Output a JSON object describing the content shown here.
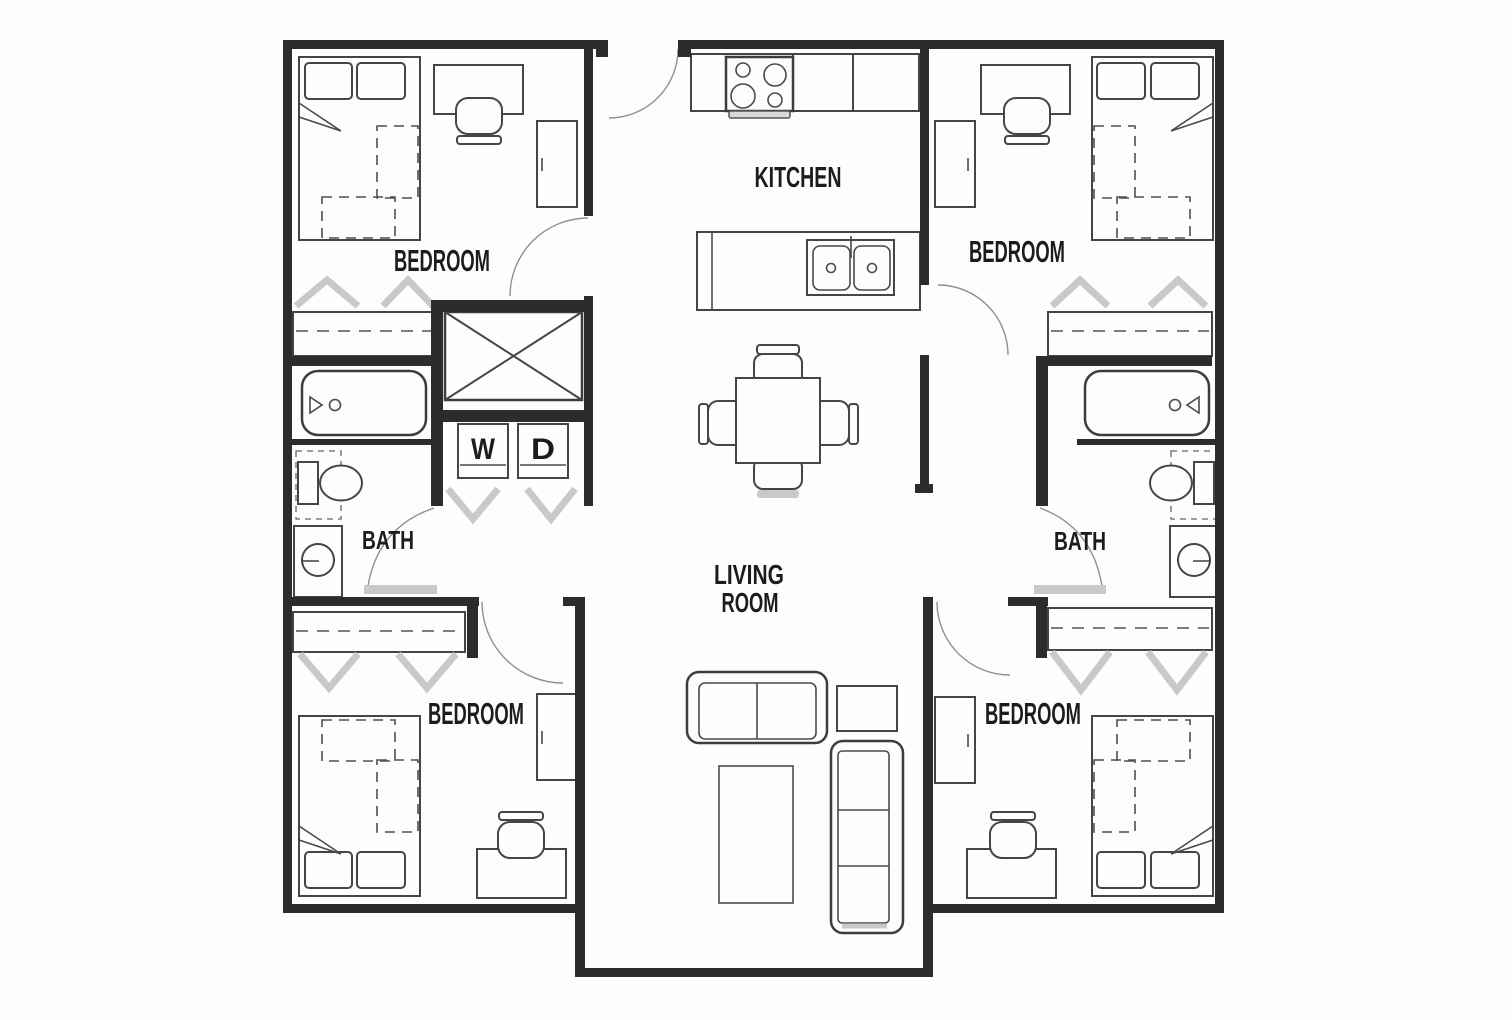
{
  "labels": {
    "bedroom_top_left": "BEDROOM",
    "bedroom_top_right": "BEDROOM",
    "bedroom_bottom_left": "BEDROOM",
    "bedroom_bottom_right": "BEDROOM",
    "kitchen": "KITCHEN",
    "bath_left": "BATH",
    "bath_right": "BATH",
    "living_room_line1": "LIVING",
    "living_room_line2": "ROOM",
    "washer": "W",
    "dryer": "D"
  },
  "colors": {
    "background": "#fdfdfb",
    "wall": "#2c2c2c",
    "furniture_line": "#454545",
    "door_arc": "#909090",
    "soft_gray": "#c9c9c9",
    "text": "#1c1c1c"
  }
}
